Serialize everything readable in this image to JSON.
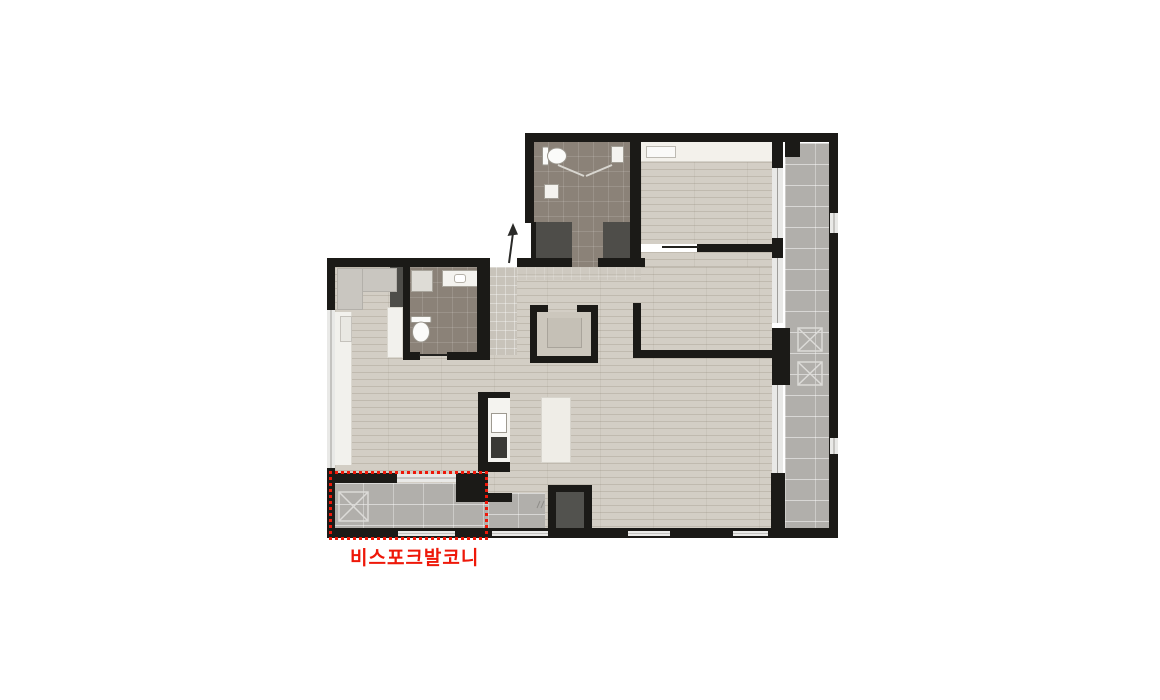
{
  "plan": {
    "balcony_label": "비스포크발코니"
  },
  "palette": {
    "wall": "#1b1a17",
    "wood_floor": "#d3cec5",
    "bath_tile": "#8b8278",
    "balcony_tile": "#b1afab",
    "entry_tile": "#c8c3ba",
    "closet_dark": "#4e4d49",
    "fixture_white": "#f4f3ef",
    "window_light": "#e9e9e7",
    "highlight_red": "#ee1809"
  }
}
